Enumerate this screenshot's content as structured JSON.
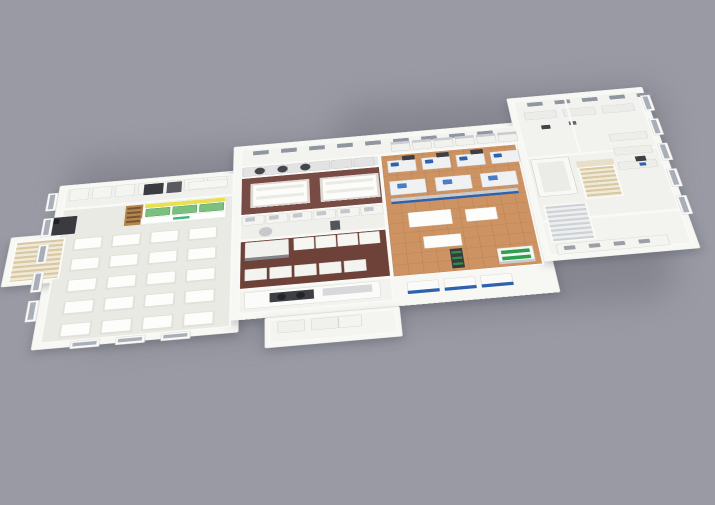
{
  "scene": {
    "background": "#999aa4",
    "palette": {
      "slab": "#f7f7f4",
      "slab_edge": "#e2e2dd",
      "wall": "#f9f9f7",
      "shadow": "#82838d",
      "floor_light": "#eaeae4",
      "floor_maroon_north": "#784b44",
      "floor_maroon_south": "#6e4239",
      "floor_wood": "#cd9362",
      "accent_blue": "#2f62ae",
      "accent_yellow": "#e9e050",
      "accent_green": "#3cb878",
      "equipment_dark": "#3b3c41",
      "steel": "#c9ccd0",
      "stair_wood": "#d8c7a0",
      "window_pane": "#a9afb8"
    },
    "shadows": [
      {
        "n": "ground-shadow-west",
        "x": 70,
        "y": 150,
        "w": 330,
        "h": 185,
        "rot": -4
      },
      {
        "n": "ground-shadow-east",
        "x": 340,
        "y": 95,
        "w": 330,
        "h": 215,
        "rot": -4
      }
    ],
    "slabs": [
      {
        "n": "slab-left-wing",
        "x": 0,
        "y": 150,
        "w": 320,
        "h": 380
      },
      {
        "n": "slab-stair-pad",
        "x": -68,
        "y": 272,
        "w": 100,
        "h": 116
      },
      {
        "n": "slab-center",
        "x": 305,
        "y": 85,
        "w": 515,
        "h": 420
      },
      {
        "n": "slab-front-annex",
        "x": 360,
        "y": 505,
        "w": 210,
        "h": 62
      },
      {
        "n": "slab-right-wing",
        "x": 805,
        "y": 15,
        "w": 250,
        "h": 422
      }
    ],
    "rooms": [
      {
        "n": "room-service-corridor",
        "x": 12,
        "y": 158,
        "w": 296,
        "h": 55,
        "f": "#f0f0ec"
      },
      {
        "n": "room-dining-training",
        "x": 12,
        "y": 213,
        "w": 296,
        "h": 305,
        "f": "#eaeae4"
      },
      {
        "n": "room-back-soffit",
        "x": 318,
        "y": 95,
        "w": 495,
        "h": 48,
        "f": "#f3f3f0"
      },
      {
        "n": "room-cook-line",
        "x": 318,
        "y": 143,
        "w": 245,
        "h": 28,
        "f": "#e6e7e5"
      },
      {
        "n": "room-lab-kitchen-north",
        "x": 318,
        "y": 171,
        "w": 245,
        "h": 98,
        "f": "#784b44"
      },
      {
        "n": "room-galley",
        "x": 318,
        "y": 269,
        "w": 245,
        "h": 60,
        "f": "#efefeb"
      },
      {
        "n": "room-lab-kitchen-south",
        "x": 318,
        "y": 329,
        "w": 245,
        "h": 112,
        "f": "#6e4239"
      },
      {
        "n": "room-servery",
        "x": 318,
        "y": 441,
        "w": 245,
        "h": 52,
        "f": "#f2f2ee"
      },
      {
        "n": "room-front-annex",
        "x": 366,
        "y": 509,
        "w": 198,
        "h": 50,
        "f": "#f4f4f0"
      },
      {
        "n": "room-production-hall",
        "x": 563,
        "y": 143,
        "w": 242,
        "h": 300,
        "f": "#cd9362",
        "pattern": "wood"
      },
      {
        "n": "room-right-labs-north",
        "x": 815,
        "y": 25,
        "w": 230,
        "h": 160,
        "f": "#f2f2ef"
      },
      {
        "n": "room-right-labs-mid",
        "x": 815,
        "y": 185,
        "w": 230,
        "h": 160,
        "f": "#f1f1ed"
      },
      {
        "n": "room-right-labs-front",
        "x": 815,
        "y": 345,
        "w": 230,
        "h": 80,
        "f": "#f3f3f0"
      }
    ],
    "items": [
      {
        "t": "grid",
        "n": "locker-row",
        "x": 20,
        "y": 162,
        "cols": 7,
        "rows": 1,
        "cw": 34,
        "ch": 30,
        "gx": 6,
        "gy": 0,
        "c": "#f4f4f1",
        "b": "#d6d6d1"
      },
      {
        "t": "block",
        "n": "dark-appliance",
        "x": 150,
        "y": 166,
        "w": 34,
        "h": 28,
        "c": "#3b3c41"
      },
      {
        "t": "block",
        "n": "gray-appliance",
        "x": 190,
        "y": 166,
        "w": 26,
        "h": 28,
        "c": "#5a5b61"
      },
      {
        "t": "block",
        "n": "prep-counter",
        "x": 228,
        "y": 170,
        "w": 68,
        "h": 20,
        "c": "#f6f6f3",
        "b": "#d8d8d3"
      },
      {
        "t": "block",
        "n": "kiosk-base",
        "x": 120,
        "y": 216,
        "w": 175,
        "h": 54,
        "c": "#fdfdfb",
        "b": "#dcdcd6"
      },
      {
        "t": "block",
        "n": "kiosk-wood-shelf",
        "x": 122,
        "y": 218,
        "w": 30,
        "h": 50,
        "c": "#b5854e"
      },
      {
        "t": "grid",
        "n": "kiosk-shelf-boards",
        "x": 125,
        "y": 223,
        "cols": 1,
        "rows": 4,
        "cw": 24,
        "ch": 5,
        "gx": 0,
        "gy": 6,
        "c": "#7a5630"
      },
      {
        "t": "block",
        "n": "kiosk-roof-yellow",
        "x": 155,
        "y": 218,
        "w": 138,
        "h": 10,
        "c": "#e9e050"
      },
      {
        "t": "grid",
        "n": "kiosk-green-shelves",
        "x": 157,
        "y": 230,
        "cols": 3,
        "rows": 1,
        "cw": 42,
        "ch": 20,
        "gx": 4,
        "gy": 0,
        "c": "#7cc07f",
        "b": "#4e9b59"
      },
      {
        "t": "block",
        "n": "kiosk-counter",
        "x": 150,
        "y": 252,
        "w": 145,
        "h": 16,
        "c": "#ffffff",
        "b": "#e0e0da"
      },
      {
        "t": "block",
        "n": "kiosk-logo-mark",
        "x": 205,
        "y": 257,
        "w": 28,
        "h": 6,
        "c": "#3cb878"
      },
      {
        "t": "grid",
        "n": "dining-table-bases",
        "x": 40,
        "y": 288,
        "cols": 4,
        "rows": 5,
        "cw": 50,
        "ch": 30,
        "gx": 14,
        "gy": 18,
        "c": "#e1e1da"
      },
      {
        "t": "grid",
        "n": "dining-table-tops",
        "x": 43,
        "y": 290,
        "cols": 4,
        "rows": 5,
        "cw": 44,
        "ch": 24,
        "gx": 20,
        "gy": 24,
        "c": "#fdfdfb"
      },
      {
        "t": "stair",
        "n": "stair-west",
        "x": -58,
        "y": 284,
        "w": 84,
        "h": 96,
        "c1": "#d8c7a0",
        "c2": "#efe9d8",
        "rail": "#fbfbf9",
        "dir": "v"
      },
      {
        "t": "block",
        "n": "copier",
        "x": -16,
        "y": 232,
        "w": 56,
        "h": 44,
        "c": "#3a3b40"
      },
      {
        "t": "block",
        "n": "copier-top",
        "x": -10,
        "y": 236,
        "w": 20,
        "h": 12,
        "c": "#1f2025"
      },
      {
        "t": "bays",
        "n": "window-bays-west",
        "x": -18,
        "y": 168,
        "count": 5,
        "stepx": 0,
        "stepy": 64,
        "w": 18,
        "h": 46
      },
      {
        "t": "bays",
        "n": "window-bays-southwest",
        "x": 60,
        "y": 518,
        "count": 3,
        "stepx": 70,
        "stepy": 0,
        "w": 46,
        "h": 16
      },
      {
        "t": "grid",
        "n": "clerestory-windows-center",
        "x": 340,
        "y": 102,
        "cols": 9,
        "rows": 1,
        "cw": 28,
        "ch": 11,
        "gx": 22,
        "gy": 0,
        "c": "#9096a0"
      },
      {
        "t": "grid",
        "n": "serving-line-units",
        "x": 585,
        "y": 110,
        "cols": 6,
        "rows": 1,
        "cw": 34,
        "ch": 26,
        "gx": 4,
        "gy": 0,
        "c": "#f1f1ee",
        "b": "#cfcfcc"
      },
      {
        "t": "grid",
        "n": "serving-line-tops",
        "x": 585,
        "y": 110,
        "cols": 6,
        "rows": 1,
        "cw": 34,
        "ch": 7,
        "gx": 4,
        "gy": 0,
        "c": "#c9ccd0"
      },
      {
        "t": "grid",
        "n": "cook-line-units",
        "x": 322,
        "y": 145,
        "cols": 6,
        "rows": 1,
        "cw": 36,
        "ch": 24,
        "gx": 3,
        "gy": 0,
        "c": "#e2e3e2",
        "b": "#c8c9c9"
      },
      {
        "t": "circle",
        "n": "tilting-kettle",
        "cx": 352,
        "cy": 157,
        "r": 9,
        "c": "#45464b"
      },
      {
        "t": "circle",
        "n": "tilting-kettle",
        "cx": 392,
        "cy": 157,
        "r": 9,
        "c": "#45464b"
      },
      {
        "t": "circle",
        "n": "tilting-kettle",
        "cx": 432,
        "cy": 157,
        "r": 9,
        "c": "#45464b"
      },
      {
        "t": "block",
        "n": "island-bench-base",
        "x": 336,
        "y": 189,
        "w": 102,
        "h": 62,
        "c": "#ded9d2"
      },
      {
        "t": "block",
        "n": "island-bench-top",
        "x": 340,
        "y": 193,
        "w": 94,
        "h": 54,
        "c": "#fcfcfa",
        "b": "#e6e4de"
      },
      {
        "t": "grid",
        "n": "island-bench-stripes",
        "x": 346,
        "y": 201,
        "cols": 1,
        "rows": 2,
        "cw": 82,
        "ch": 8,
        "gx": 0,
        "gy": 14,
        "c": "#ebebe5"
      },
      {
        "t": "block",
        "n": "island-bench-base",
        "x": 456,
        "y": 189,
        "w": 102,
        "h": 62,
        "c": "#ded9d2"
      },
      {
        "t": "block",
        "n": "island-bench-top",
        "x": 460,
        "y": 193,
        "w": 94,
        "h": 54,
        "c": "#fcfcfa",
        "b": "#e6e4de"
      },
      {
        "t": "grid",
        "n": "island-bench-stripes",
        "x": 466,
        "y": 201,
        "cols": 1,
        "rows": 2,
        "cw": 82,
        "ch": 8,
        "gx": 0,
        "gy": 14,
        "c": "#ebebe5"
      },
      {
        "t": "grid",
        "n": "galley-counters",
        "x": 322,
        "y": 271,
        "cols": 6,
        "rows": 1,
        "cw": 38,
        "ch": 22,
        "gx": 2,
        "gy": 0,
        "c": "#f4f4f1",
        "b": "#d6d6d1"
      },
      {
        "t": "grid",
        "n": "galley-equipment-tops",
        "x": 328,
        "y": 274,
        "cols": 6,
        "rows": 1,
        "cw": 16,
        "ch": 10,
        "gx": 24,
        "gy": 0,
        "c": "#c3c6ca"
      },
      {
        "t": "block",
        "n": "stand-mixer",
        "x": 470,
        "y": 300,
        "w": 16,
        "h": 22,
        "c": "#54555b"
      },
      {
        "t": "circle",
        "n": "round-kettle",
        "cx": 362,
        "cy": 312,
        "r": 11,
        "c": "#c6c8cb"
      },
      {
        "t": "block",
        "n": "hood-station",
        "x": 328,
        "y": 334,
        "w": 72,
        "h": 42,
        "c": "#f1f1ee",
        "b": "#d4d4cf"
      },
      {
        "t": "block",
        "n": "hood-station-vent",
        "x": 328,
        "y": 370,
        "w": 72,
        "h": 7,
        "c": "#83858a"
      },
      {
        "t": "grid",
        "n": "south-kitchen-equipment",
        "x": 408,
        "y": 334,
        "cols": 4,
        "rows": 1,
        "cw": 34,
        "ch": 28,
        "gx": 2,
        "gy": 0,
        "c": "#f6f6f3",
        "b": "#d9d9d4"
      },
      {
        "t": "grid",
        "n": "south-kitchen-counters",
        "x": 328,
        "y": 396,
        "cols": 5,
        "rows": 1,
        "cw": 36,
        "ch": 26,
        "gx": 4,
        "gy": 0,
        "c": "#f3f3f0",
        "b": "#d7d7d2"
      },
      {
        "t": "block",
        "n": "servery-counter",
        "x": 328,
        "y": 447,
        "w": 215,
        "h": 36,
        "c": "#fbfbf9",
        "b": "#dadad5"
      },
      {
        "t": "block",
        "n": "cooktop-frame",
        "x": 368,
        "y": 453,
        "w": 70,
        "h": 20,
        "c": "#3e3f44"
      },
      {
        "t": "circle",
        "n": "burner",
        "cx": 387,
        "cy": 463,
        "r": 7,
        "c": "#23242a"
      },
      {
        "t": "circle",
        "n": "burner",
        "cx": 417,
        "cy": 463,
        "r": 7,
        "c": "#23242a"
      },
      {
        "t": "block",
        "n": "servery-steel-top",
        "x": 452,
        "y": 453,
        "w": 78,
        "h": 16,
        "c": "#d6d8da"
      },
      {
        "t": "grid",
        "n": "annex-cots",
        "x": 380,
        "y": 515,
        "cols": 2,
        "rows": 1,
        "cw": 42,
        "ch": 24,
        "gx": 10,
        "gy": 0,
        "c": "#f0f0ec",
        "b": "#d8d8d2"
      },
      {
        "t": "block",
        "n": "annex-cabinet",
        "x": 474,
        "y": 515,
        "w": 36,
        "h": 24,
        "c": "#f4f4f1",
        "b": "#d8d8d2"
      },
      {
        "t": "grid",
        "n": "blue-front-counters",
        "x": 585,
        "y": 455,
        "cols": 3,
        "rows": 1,
        "cw": 50,
        "ch": 26,
        "gx": 8,
        "gy": 0,
        "c": "#fafaf8",
        "b": "#d9d9d4"
      },
      {
        "t": "grid",
        "n": "blue-front-stripes",
        "x": 585,
        "y": 474,
        "cols": 3,
        "rows": 1,
        "cw": 50,
        "ch": 7,
        "gx": 8,
        "gy": 0,
        "c": "#2f62ae"
      },
      {
        "t": "grid",
        "n": "process-machines-north",
        "x": 575,
        "y": 160,
        "cols": 4,
        "rows": 1,
        "cw": 50,
        "ch": 32,
        "gx": 10,
        "gy": 0,
        "c": "#eef0f1",
        "b": "#c7cacd"
      },
      {
        "t": "grid",
        "n": "machine-blue-modules",
        "x": 581,
        "y": 166,
        "cols": 4,
        "rows": 1,
        "cw": 14,
        "ch": 10,
        "gx": 46,
        "gy": 0,
        "c": "#2f62ae"
      },
      {
        "t": "grid",
        "n": "machine-hoppers",
        "x": 602,
        "y": 150,
        "cols": 3,
        "rows": 1,
        "cw": 22,
        "ch": 12,
        "gx": 38,
        "gy": 0,
        "c": "#3e3f44"
      },
      {
        "t": "grid",
        "n": "process-machines-mid",
        "x": 575,
        "y": 214,
        "cols": 3,
        "rows": 1,
        "cw": 62,
        "ch": 36,
        "gx": 16,
        "gy": 0,
        "c": "#f0f1f2",
        "b": "#c9ccce"
      },
      {
        "t": "grid",
        "n": "machine-blue-panels",
        "x": 588,
        "y": 222,
        "cols": 3,
        "rows": 1,
        "cw": 16,
        "ch": 12,
        "gx": 62,
        "gy": 0,
        "c": "#4a7ec2"
      },
      {
        "t": "block",
        "n": "conveyor-steel",
        "x": 575,
        "y": 258,
        "w": 215,
        "h": 8,
        "c": "#c8cbce"
      },
      {
        "t": "block",
        "n": "conveyor-belt-blue",
        "x": 575,
        "y": 266,
        "w": 215,
        "h": 6,
        "c": "#2f62ae"
      },
      {
        "t": "block",
        "n": "work-table",
        "x": 600,
        "y": 296,
        "w": 72,
        "h": 36,
        "c": "#fdfdfb",
        "b": "#e0e0da"
      },
      {
        "t": "block",
        "n": "work-table",
        "x": 695,
        "y": 300,
        "w": 52,
        "h": 30,
        "c": "#fdfdfb",
        "b": "#e0e0da"
      },
      {
        "t": "block",
        "n": "work-table",
        "x": 620,
        "y": 356,
        "w": 62,
        "h": 28,
        "c": "#fcfcfa",
        "b": "#e0e0da"
      },
      {
        "t": "block",
        "n": "retail-shelf-dark",
        "x": 660,
        "y": 390,
        "w": 20,
        "h": 44,
        "c": "#393a3f"
      },
      {
        "t": "grid",
        "n": "retail-shelf-greens",
        "x": 662,
        "y": 396,
        "cols": 1,
        "rows": 3,
        "cw": 16,
        "ch": 5,
        "gx": 0,
        "gy": 8,
        "c": "#2f8f46"
      },
      {
        "t": "block",
        "n": "produce-case",
        "x": 735,
        "y": 398,
        "w": 58,
        "h": 36,
        "c": "#f6f6f3",
        "b": "#cfcfca"
      },
      {
        "t": "grid",
        "n": "produce-case-greens",
        "x": 741,
        "y": 404,
        "cols": 1,
        "rows": 2,
        "cw": 46,
        "ch": 8,
        "gx": 0,
        "gy": 6,
        "c": "#2e9e4f"
      },
      {
        "t": "block",
        "n": "produce-case-base",
        "x": 735,
        "y": 428,
        "w": 58,
        "h": 6,
        "c": "#c9ccce"
      },
      {
        "t": "grid",
        "n": "clerestory-windows-east",
        "x": 840,
        "y": 33,
        "cols": 5,
        "rows": 1,
        "cw": 28,
        "ch": 11,
        "gx": 22,
        "gy": 0,
        "c": "#9096a0"
      },
      {
        "t": "grid",
        "n": "lab-benches-north",
        "x": 830,
        "y": 60,
        "cols": 3,
        "rows": 1,
        "cw": 58,
        "ch": 22,
        "gx": 12,
        "gy": 0,
        "c": "#ececea",
        "b": "#d2d2cd"
      },
      {
        "t": "block",
        "n": "analyzer",
        "x": 855,
        "y": 100,
        "w": 16,
        "h": 11,
        "c": "#44454a"
      },
      {
        "t": "block",
        "n": "analyzer",
        "x": 905,
        "y": 96,
        "w": 13,
        "h": 10,
        "c": "#62646b"
      },
      {
        "t": "block",
        "n": "partition-wall",
        "x": 908,
        "y": 25,
        "w": 4,
        "h": 157,
        "c": "#f8f8f6"
      },
      {
        "t": "block",
        "n": "partition-wall",
        "x": 815,
        "y": 182,
        "w": 230,
        "h": 4,
        "c": "#f8f8f6"
      },
      {
        "t": "block",
        "n": "elevator-shaft",
        "x": 822,
        "y": 190,
        "w": 66,
        "h": 96,
        "c": "#f8f8f5",
        "b": "#c9c9c4"
      },
      {
        "t": "block",
        "n": "elevator-cab",
        "x": 832,
        "y": 200,
        "w": 46,
        "h": 76,
        "c": "#ebebe7"
      },
      {
        "t": "block",
        "n": "stair-landing",
        "x": 898,
        "y": 205,
        "w": 64,
        "h": 16,
        "c": "#e8dfc8"
      },
      {
        "t": "stair",
        "n": "stair-east-main",
        "x": 898,
        "y": 221,
        "w": 64,
        "h": 80,
        "c1": "#d8c7a0",
        "c2": "#efe9d8",
        "rail": "#fbfbf9",
        "dir": "v"
      },
      {
        "t": "stair",
        "n": "stair-east-steel",
        "x": 825,
        "y": 308,
        "w": 72,
        "h": 88,
        "c1": "#cfd2d5",
        "c2": "#eceeef",
        "rail": "#fafaf8",
        "dir": "v"
      },
      {
        "t": "grid",
        "n": "lab-benches-east",
        "x": 968,
        "y": 140,
        "cols": 1,
        "rows": 3,
        "cw": 66,
        "ch": 20,
        "gx": 0,
        "gy": 18,
        "c": "#ededea",
        "b": "#d3d3ce"
      },
      {
        "t": "block",
        "n": "robot-arm-unit",
        "x": 1000,
        "y": 205,
        "w": 18,
        "h": 13,
        "c": "#3f4045"
      },
      {
        "t": "block",
        "n": "robot-arm-blue",
        "x": 1004,
        "y": 222,
        "w": 11,
        "h": 8,
        "c": "#2f62ae"
      },
      {
        "t": "block",
        "n": "south-counter-east",
        "x": 830,
        "y": 400,
        "w": 180,
        "h": 24,
        "c": "#f4f4f1",
        "b": "#d7d7d2"
      },
      {
        "t": "grid",
        "n": "south-counter-vents",
        "x": 842,
        "y": 406,
        "cols": 4,
        "rows": 1,
        "cw": 18,
        "ch": 9,
        "gx": 22,
        "gy": 0,
        "c": "#9aa0a6"
      },
      {
        "t": "bays",
        "n": "window-bays-east",
        "x": 1045,
        "y": 40,
        "count": 5,
        "stepx": 0,
        "stepy": 68,
        "w": 18,
        "h": 46
      }
    ]
  }
}
